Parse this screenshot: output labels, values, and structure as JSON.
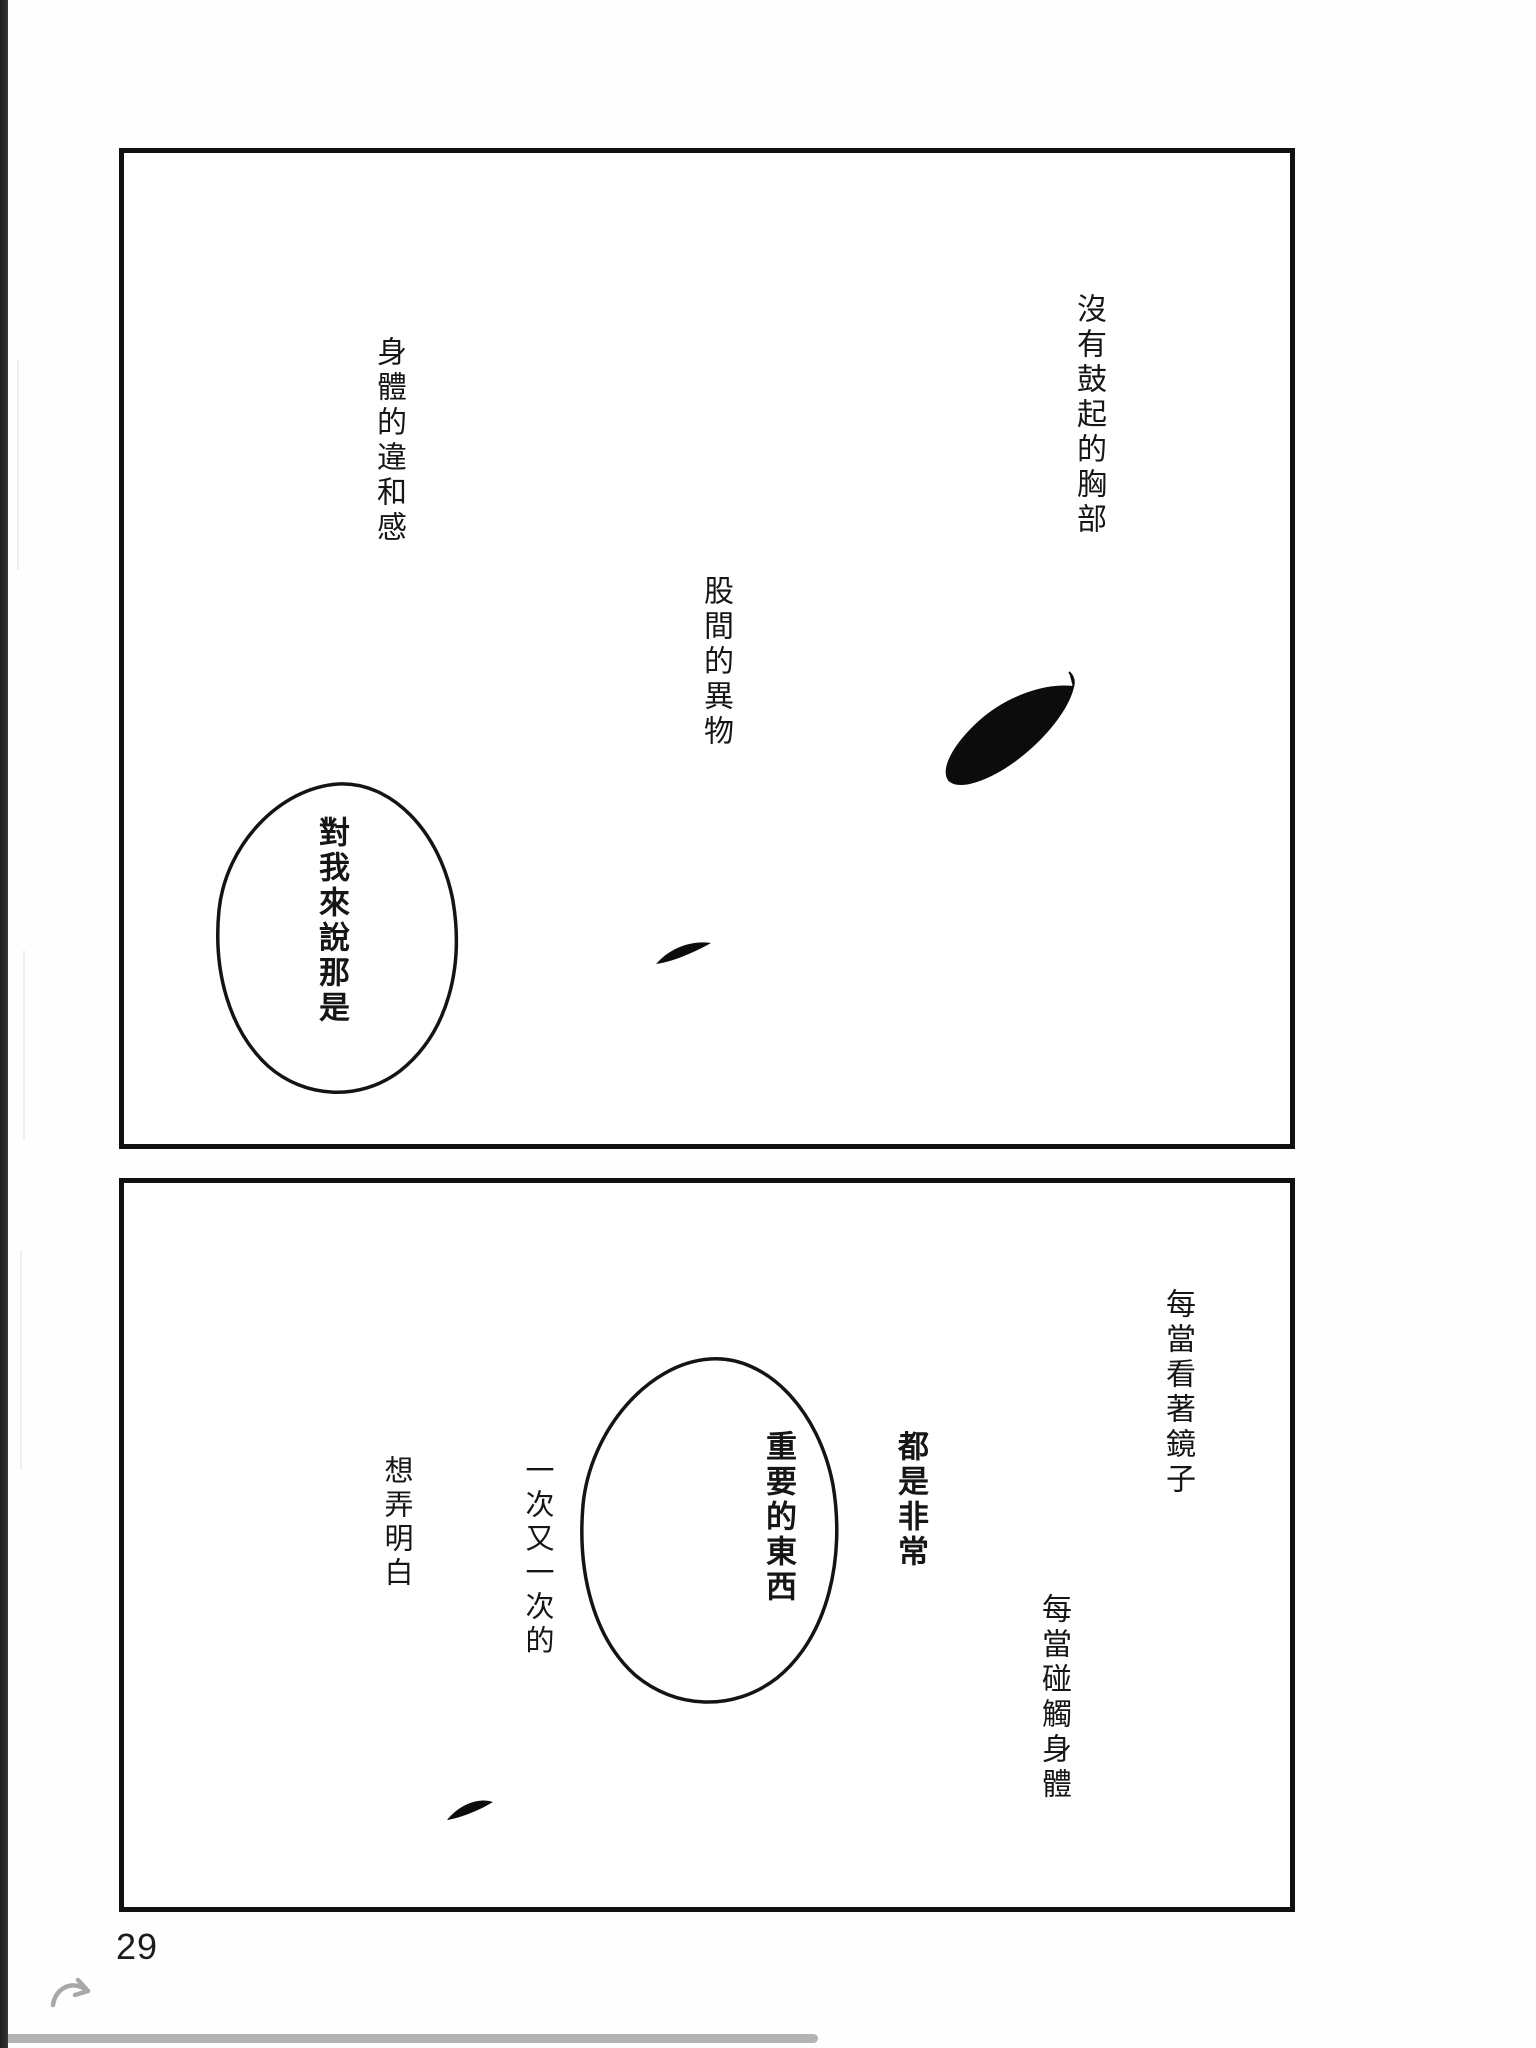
{
  "page": {
    "number": "29",
    "background_color": "#ffffff",
    "spine_color": "#2d2d2d",
    "ink_color": "#111111",
    "accent_gray": "#b3b3b3"
  },
  "panel1": {
    "narration_chest": "沒有鼓起的胸部",
    "narration_body": "身體的違和感",
    "narration_crotch": "股間的異物",
    "bubble_text": "對我來說那是"
  },
  "panel2": {
    "narration_mirror": "每當看著鏡子",
    "narration_touch": "每當碰觸身體",
    "bubble_line1": "都是非常",
    "bubble_line2": "重要的東西",
    "narration_again_line1": "一次又一次的",
    "narration_again_line2": "想弄明白"
  },
  "footer": {
    "page_number": "29",
    "arrow_icon": "curved-turn-arrow-icon",
    "progress_bar": "reading-progress"
  }
}
